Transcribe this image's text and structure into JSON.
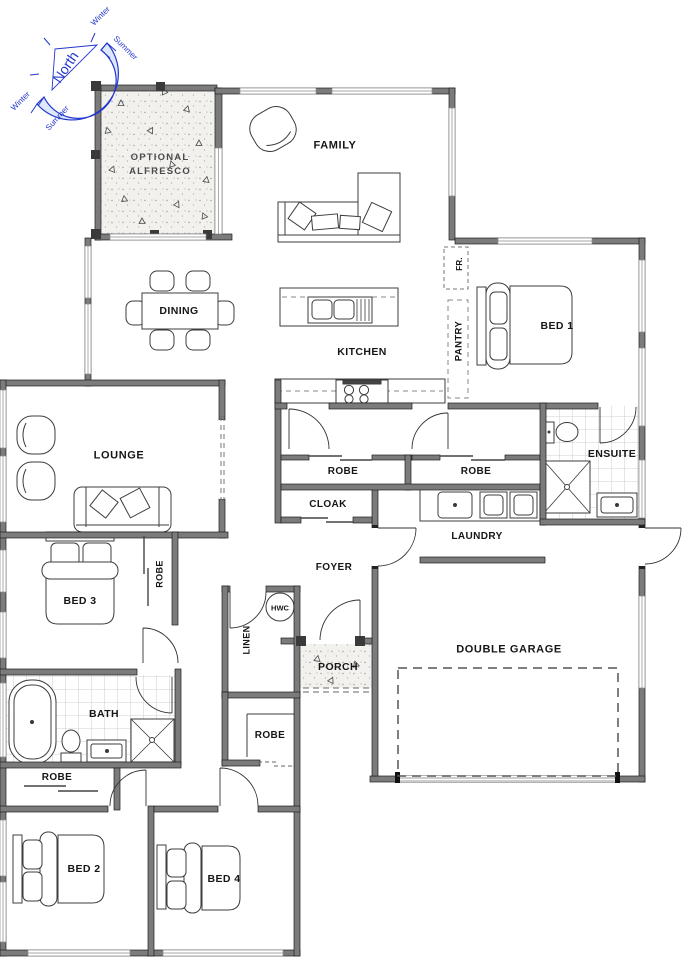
{
  "compass": {
    "north": "North",
    "winter": "Winter",
    "summer": "Summer"
  },
  "labels": {
    "alfresco1": "OPTIONAL",
    "alfresco2": "ALFRESCO",
    "family": "FAMILY",
    "dining": "DINING",
    "kitchen": "KITCHEN",
    "pantry": "PANTRY",
    "fridge": "FR.",
    "bed1": "BED 1",
    "ensuite": "ENSUITE",
    "lounge": "LOUNGE",
    "robe_hall_left": "ROBE",
    "robe_hall_right": "ROBE",
    "cloak": "CLOAK",
    "laundry": "LAUNDRY",
    "foyer": "FOYER",
    "bed3": "BED 3",
    "robe_bed3": "ROBE",
    "linen": "LINEN",
    "hwc": "HWC",
    "porch": "PORCH",
    "garage": "DOUBLE GARAGE",
    "bath": "BATH",
    "robe_bed2": "ROBE",
    "robe_mid": "ROBE",
    "bed2": "BED 2",
    "bed4": "BED 4"
  },
  "colors": {
    "wall": "#7b7b7b",
    "wall_outline": "#1f1f1f",
    "compass_blue": "#2336cf",
    "text": "#161616",
    "concrete": "#f2f1ee",
    "tile_line": "#c2c2c2"
  }
}
